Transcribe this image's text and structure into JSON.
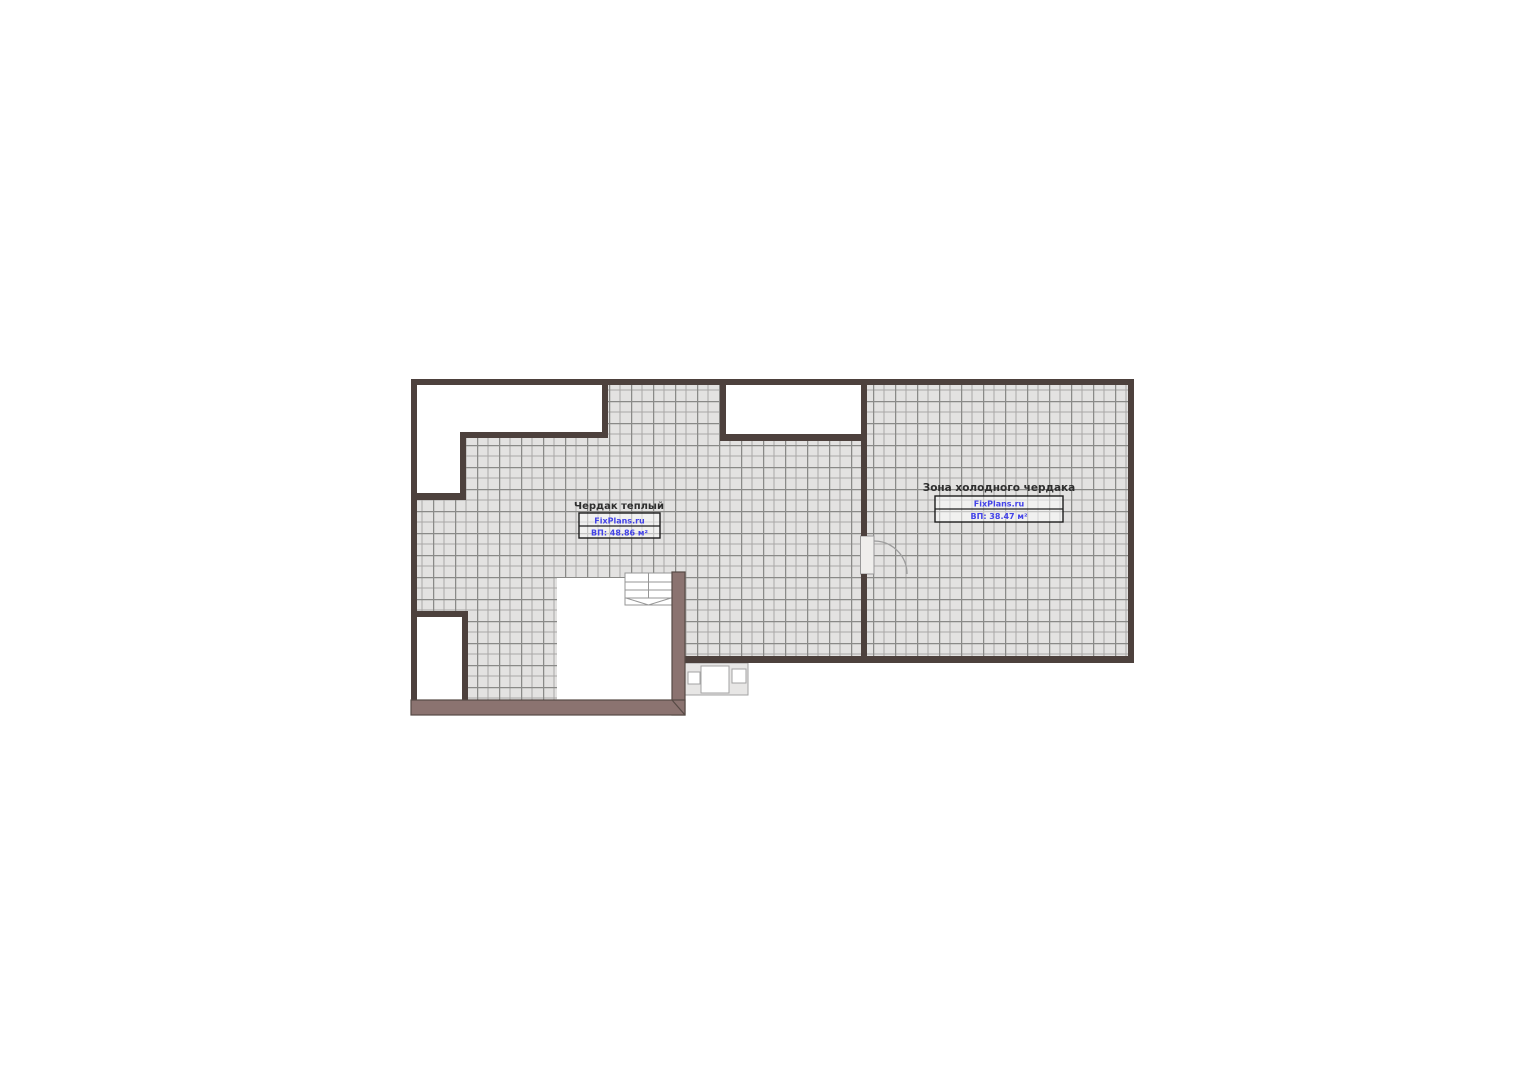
{
  "plan": {
    "type": "floor-plan",
    "rooms": [
      {
        "id": "warm-attic",
        "name": "Чердак теплый",
        "watermark": "FixPlans.ru",
        "area": "ВП: 48.86 м²"
      },
      {
        "id": "cold-attic",
        "name": "Зона холодного чердака",
        "watermark": "FixPlans.ru",
        "area": "ВП: 38.47 м²"
      }
    ],
    "colors": {
      "wall": "#4d413d",
      "thick_wall": "#8b7370",
      "thick_wall_edge": "#564a45",
      "hatch_bg": "#e3e2e1",
      "grid_line_major": "#8a8a88",
      "grid_line_minor": "#a9a8a6",
      "label_title": "#2e2e2e",
      "label_blue": "#4343e8",
      "symbol_line": "#969696"
    }
  }
}
